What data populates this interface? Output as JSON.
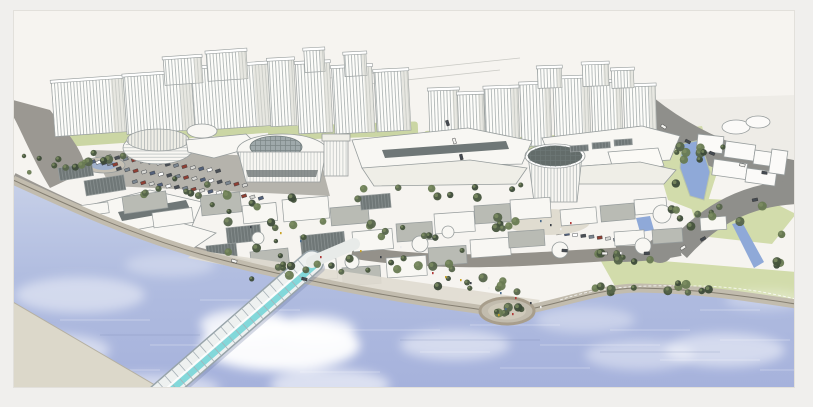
{
  "palette": {
    "frame": "#f0efed",
    "edge": "#e2e0db",
    "sky": "#f6f4f0",
    "skyband": "#eeece7",
    "ink": "#969c9c",
    "towerface": "#fdfdfa",
    "towershade": "#d9d8d1",
    "stripe": "#a7aeae",
    "greenbase": "#cbd6a4",
    "lawn": "#d2dcab",
    "treedark": "#3f4f3a",
    "pond": "#8fa9d8",
    "road": "#8f8f8b",
    "road2": "#9b9892",
    "roof": "#f8f7f3",
    "roof2": "#efeee7",
    "roofshadow": "#dddbd2",
    "facade": "#6f7777",
    "glass": "#9fa9ab",
    "glass2": "#7ed7d9",
    "drumroof": "#636c6a",
    "plaza": "#e0dcd0",
    "prom": "#c2bcae",
    "sand": "#dcd8ca",
    "water1": "#c7d0e8",
    "water2": "#b1bde0",
    "water3": "#a6b2dc",
    "watershadow": "#7c88ae",
    "cloud": "#ffffff",
    "bridgecanopy": "#eef1f0",
    "bridgeframe": "#98a4aa",
    "riblines": "#a8b2b8"
  },
  "frame_rect": {
    "x": 13,
    "y": 10,
    "w": 782,
    "h": 378
  },
  "scene": {
    "towers": [
      [
        55,
        80,
        74,
        54,
        -4
      ],
      [
        127,
        74,
        70,
        58,
        -4
      ],
      [
        195,
        66,
        78,
        62,
        -4
      ],
      [
        165,
        58,
        38,
        26,
        -4
      ],
      [
        208,
        52,
        40,
        28,
        -4
      ],
      [
        271,
        60,
        26,
        66,
        -3
      ],
      [
        299,
        63,
        34,
        70,
        -3
      ],
      [
        335,
        67,
        40,
        66,
        -3
      ],
      [
        377,
        71,
        34,
        60,
        -3
      ],
      [
        305,
        50,
        20,
        22,
        -3
      ],
      [
        345,
        54,
        22,
        22,
        -3
      ],
      [
        430,
        90,
        30,
        48,
        -2
      ],
      [
        459,
        94,
        26,
        44,
        -2
      ],
      [
        486,
        88,
        34,
        58,
        -2
      ],
      [
        522,
        84,
        30,
        62,
        -2
      ],
      [
        555,
        78,
        36,
        64,
        -2
      ],
      [
        593,
        82,
        30,
        58,
        -2
      ],
      [
        625,
        86,
        32,
        52,
        -2
      ],
      [
        538,
        68,
        24,
        20,
        -2
      ],
      [
        583,
        64,
        26,
        22,
        -2
      ],
      [
        612,
        70,
        22,
        18,
        -2
      ]
    ],
    "green_bases": [
      [
        52,
        124,
        225,
        16,
        -4
      ],
      [
        268,
        124,
        150,
        14,
        -2
      ],
      [
        424,
        130,
        56,
        12,
        -2
      ],
      [
        484,
        134,
        185,
        15,
        -3
      ]
    ],
    "context_outlines": {
      "rects": [
        [
          698,
          134,
          26,
          17,
          6
        ],
        [
          726,
          141,
          30,
          16,
          8
        ],
        [
          755,
          150,
          26,
          14,
          8
        ],
        [
          714,
          159,
          34,
          16,
          8
        ],
        [
          747,
          168,
          30,
          14,
          8
        ],
        [
          772,
          149,
          16,
          24,
          8
        ]
      ],
      "ellipses": [
        [
          736,
          127,
          14,
          7
        ],
        [
          758,
          122,
          12,
          6
        ]
      ]
    },
    "blocks": [
      [
        58,
        168,
        34,
        13,
        -9,
        "k"
      ],
      [
        84,
        181,
        40,
        15,
        -9,
        "k"
      ],
      [
        122,
        197,
        44,
        17,
        -8,
        "g"
      ],
      [
        152,
        213,
        40,
        15,
        -8,
        "w"
      ],
      [
        78,
        206,
        30,
        11,
        -8,
        "w"
      ],
      [
        200,
        196,
        40,
        20,
        -6,
        "g"
      ],
      [
        242,
        206,
        34,
        18,
        -6,
        "w"
      ],
      [
        282,
        200,
        46,
        22,
        -5,
        "w"
      ],
      [
        330,
        208,
        38,
        18,
        -5,
        "g"
      ],
      [
        300,
        236,
        44,
        20,
        -6,
        "k"
      ],
      [
        352,
        232,
        40,
        20,
        -5,
        "w"
      ],
      [
        396,
        224,
        36,
        18,
        -4,
        "g"
      ],
      [
        434,
        214,
        40,
        20,
        -4,
        "w"
      ],
      [
        474,
        206,
        36,
        18,
        -4,
        "g"
      ],
      [
        510,
        200,
        40,
        20,
        -4,
        "w"
      ],
      [
        250,
        252,
        38,
        18,
        -6,
        "g"
      ],
      [
        294,
        262,
        42,
        20,
        -5,
        "w"
      ],
      [
        342,
        268,
        38,
        18,
        -4,
        "g"
      ],
      [
        386,
        258,
        40,
        20,
        -4,
        "w"
      ],
      [
        428,
        248,
        38,
        18,
        -4,
        "g"
      ],
      [
        470,
        240,
        40,
        18,
        -4,
        "w"
      ],
      [
        508,
        232,
        36,
        16,
        -4,
        "g"
      ],
      [
        226,
        228,
        34,
        16,
        -6,
        "k"
      ],
      [
        206,
        246,
        30,
        14,
        -6,
        "k"
      ],
      [
        360,
        196,
        30,
        14,
        -5,
        "k"
      ],
      [
        570,
        146,
        18,
        6,
        -4,
        "k"
      ],
      [
        592,
        143,
        18,
        6,
        -4,
        "k"
      ],
      [
        614,
        140,
        18,
        6,
        -4,
        "k"
      ],
      [
        560,
        210,
        36,
        16,
        -5,
        "w"
      ],
      [
        600,
        206,
        34,
        16,
        -5,
        "g"
      ],
      [
        634,
        200,
        32,
        15,
        -5,
        "w"
      ],
      [
        652,
        230,
        30,
        14,
        -4,
        "g"
      ],
      [
        614,
        232,
        30,
        14,
        -4,
        "w"
      ],
      [
        700,
        218,
        26,
        13,
        -4,
        "w"
      ]
    ],
    "kiosks": [
      [
        420,
        244,
        8
      ],
      [
        352,
        262,
        7
      ],
      [
        560,
        250,
        8
      ],
      [
        643,
        246,
        8
      ],
      [
        662,
        214,
        9
      ],
      [
        448,
        232,
        6
      ],
      [
        258,
        238,
        6
      ]
    ],
    "car_rows": [
      {
        "x": 106,
        "y": 156,
        "n": 14,
        "dx": 8.4,
        "dy": 1.1,
        "rot": -18
      },
      {
        "x": 116,
        "y": 168,
        "n": 16,
        "dx": 8.4,
        "dy": 1.1,
        "rot": -18
      },
      {
        "x": 132,
        "y": 181,
        "n": 16,
        "dx": 8.4,
        "dy": 1.1,
        "rot": -18
      },
      {
        "x": 246,
        "y": 158,
        "n": 9,
        "dx": 8.0,
        "dy": 0.8,
        "rot": -18
      },
      {
        "x": 556,
        "y": 232,
        "n": 9,
        "dx": 8.2,
        "dy": 0.9,
        "rot": -8
      },
      {
        "x": 90,
        "y": 161,
        "n": 5,
        "dx": 5.6,
        "dy": 0.7,
        "rot": -18
      }
    ],
    "car_colors": [
      "#ffffff",
      "#4a4f55",
      "#7b8690",
      "#8f3f33",
      "#d8d8d4",
      "#52607a"
    ],
    "road_cars": [
      [
        662,
        124,
        32
      ],
      [
        686,
        139,
        28
      ],
      [
        710,
        151,
        22
      ],
      [
        740,
        163,
        14
      ],
      [
        762,
        171,
        8
      ],
      [
        700,
        239,
        -28
      ],
      [
        680,
        248,
        -34
      ],
      [
        752,
        199,
        -12
      ],
      [
        448,
        120,
        72
      ],
      [
        455,
        138,
        74
      ],
      [
        462,
        154,
        76
      ],
      [
        562,
        249,
        4
      ],
      [
        602,
        252,
        1
      ],
      [
        644,
        252,
        -2
      ],
      [
        302,
        277,
        13
      ],
      [
        232,
        259,
        17
      ]
    ],
    "tree_colors": [
      "#46543c",
      "#55644a",
      "#687a52",
      "#3c4a38"
    ],
    "tree_clusters": [
      [
        70,
        166,
        9,
        46,
        10
      ],
      [
        104,
        158,
        5,
        22,
        6
      ],
      [
        178,
        190,
        8,
        50,
        12
      ],
      [
        250,
        216,
        12,
        55,
        22
      ],
      [
        360,
        238,
        24,
        140,
        38
      ],
      [
        470,
        285,
        9,
        55,
        9
      ],
      [
        330,
        272,
        10,
        105,
        8
      ],
      [
        507,
        310,
        7,
        15,
        5
      ],
      [
        688,
        288,
        14,
        95,
        5
      ],
      [
        718,
        224,
        10,
        55,
        22
      ],
      [
        686,
        168,
        6,
        14,
        22
      ],
      [
        600,
        258,
        8,
        66,
        5
      ],
      [
        700,
        150,
        4,
        24,
        6
      ],
      [
        510,
        222,
        6,
        18,
        8
      ],
      [
        780,
        250,
        5,
        12,
        20
      ],
      [
        440,
        192,
        10,
        90,
        7
      ]
    ],
    "clouds": [
      [
        80,
        295,
        65,
        18,
        0.45
      ],
      [
        55,
        350,
        55,
        16,
        0.5
      ],
      [
        170,
        265,
        45,
        12,
        0.3
      ],
      [
        280,
        345,
        80,
        26,
        0.95
      ],
      [
        245,
        325,
        45,
        16,
        0.8
      ],
      [
        315,
        330,
        40,
        15,
        0.7
      ],
      [
        330,
        385,
        60,
        16,
        0.6
      ],
      [
        455,
        345,
        55,
        15,
        0.5
      ],
      [
        585,
        320,
        50,
        13,
        0.35
      ],
      [
        640,
        355,
        55,
        15,
        0.4
      ],
      [
        725,
        350,
        60,
        17,
        0.5
      ],
      [
        765,
        300,
        40,
        10,
        0.3
      ],
      [
        490,
        300,
        30,
        9,
        0.3
      ],
      [
        150,
        388,
        70,
        14,
        0.5
      ]
    ],
    "ripples": [
      [
        60,
        320,
        90
      ],
      [
        150,
        345,
        120
      ],
      [
        90,
        370,
        70
      ],
      [
        240,
        310,
        60
      ],
      [
        330,
        330,
        110
      ],
      [
        300,
        372,
        80
      ],
      [
        420,
        352,
        70
      ],
      [
        470,
        325,
        90
      ],
      [
        540,
        345,
        120
      ],
      [
        610,
        330,
        80
      ],
      [
        660,
        360,
        100
      ],
      [
        720,
        340,
        70
      ],
      [
        200,
        300,
        50
      ],
      [
        500,
        368,
        90
      ],
      [
        700,
        310,
        60
      ],
      [
        760,
        370,
        50
      ]
    ],
    "dark_streaks": [
      [
        100,
        335,
        100
      ],
      [
        400,
        340,
        140
      ],
      [
        600,
        352,
        120
      ]
    ],
    "people": [
      [
        432,
        272
      ],
      [
        445,
        276
      ],
      [
        470,
        282
      ],
      [
        488,
        287
      ],
      [
        500,
        292
      ],
      [
        515,
        297
      ],
      [
        460,
        279
      ],
      [
        530,
        302
      ],
      [
        540,
        306
      ],
      [
        505,
        308
      ],
      [
        512,
        313
      ],
      [
        498,
        314
      ],
      [
        550,
        224
      ],
      [
        560,
        228
      ],
      [
        540,
        220
      ],
      [
        570,
        222
      ],
      [
        360,
        250
      ],
      [
        380,
        256
      ],
      [
        400,
        246
      ],
      [
        300,
        240
      ],
      [
        320,
        256
      ],
      [
        280,
        232
      ],
      [
        250,
        226
      ],
      [
        620,
        252
      ]
    ],
    "people_colors": [
      "#b03a38",
      "#c9a227",
      "#3a3f46",
      "#ececec",
      "#4a6a8a"
    ],
    "bridge": {
      "x1": 158,
      "y1": 396,
      "x2": 312,
      "y2": 262,
      "width": 21,
      "ribs": 22,
      "walk_x2": 354,
      "walk_y2": 244
    }
  }
}
